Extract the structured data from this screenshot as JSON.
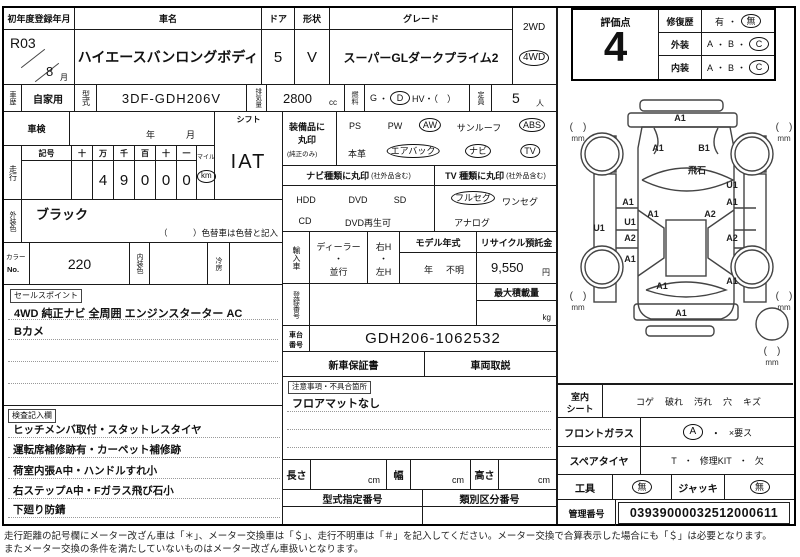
{
  "title_row": {
    "first_reg_label": "初年度登録年月",
    "first_reg_era": "R03",
    "first_reg_month": "8",
    "month_unit": "月",
    "car_name_label": "車名",
    "car_name": "ハイエースバンロングボディ",
    "door_label": "ドア",
    "door_count": "5",
    "shape_label": "形状",
    "shape": "V",
    "grade_label": "グレード",
    "grade": "スーパーGLダークプライム2",
    "drive_2wd": "2WD",
    "drive_4wd": "4WD",
    "drive_selected": "4WD"
  },
  "spec_row": {
    "history_label": "車歴",
    "history": "自家用",
    "model_label": "型式",
    "model_code": "3DF-GDH206V",
    "disp_label": "排気量",
    "displacement": "2800",
    "disp_unit": "cc",
    "fuel_label": "燃料",
    "fuel_gas": "G",
    "fuel_dot": "・",
    "fuel_diesel": "D",
    "fuel_hv": "HV・（　）",
    "fuel_selected": "D",
    "capacity_label": "定員",
    "capacity": "5",
    "capacity_unit": "人"
  },
  "shaken": {
    "label": "車検",
    "year_label": "年",
    "month_label": "月"
  },
  "shift": {
    "label": "シフト",
    "value": "IAT"
  },
  "odometer": {
    "label": "走行",
    "symbol_label": "記号",
    "digit_headers": [
      "十",
      "万",
      "千",
      "百",
      "十",
      "一"
    ],
    "digits": [
      "",
      "4",
      "9",
      "0",
      "0",
      "0"
    ],
    "mile_label": "マイル",
    "km_label": "km",
    "unit_selected": "km"
  },
  "equipment": {
    "label_line1": "装備品に",
    "label_line2": "丸印",
    "label_line3": "(純正のみ)",
    "row1": [
      {
        "label": "PS",
        "circled": false
      },
      {
        "label": "PW",
        "circled": false
      },
      {
        "label": "AW",
        "circled": true
      },
      {
        "label": "サンルーフ",
        "circled": false
      },
      {
        "label": "ABS",
        "circled": true
      }
    ],
    "row2": [
      {
        "label": "本革",
        "circled": false
      },
      {
        "label": "エアバック",
        "circled": true
      },
      {
        "label": "ナビ",
        "circled": true
      },
      {
        "label": "TV",
        "circled": true
      }
    ]
  },
  "nav_type": {
    "header": "ナビ種類に丸印",
    "header_note": "(社外品含む)",
    "row1": [
      "HDD",
      "DVD",
      "SD"
    ],
    "row2": [
      "CD",
      "DVD再生可"
    ]
  },
  "tv_type": {
    "header": "TV 種類に丸印",
    "header_note": "(社外品含む)",
    "row1": [
      {
        "label": "フルセグ",
        "circled": true
      },
      {
        "label": "ワンセグ",
        "circled": false
      }
    ],
    "row2": [
      "アナログ"
    ]
  },
  "exterior_color": {
    "label": "外装色",
    "value": "ブラック",
    "note": "（　　　）色替車は色替と記入"
  },
  "color_row": {
    "color_no_label1": "カラー",
    "color_no_label2": "No.",
    "color_no": "220",
    "interior_color_label": "内装色",
    "interior_color": "",
    "ac_label": "冷房",
    "ac": ""
  },
  "import_row": {
    "label": "輸入車",
    "dealer": "ディーラー",
    "dot": "・",
    "parallel": "並行",
    "rh": "右H",
    "lh": "左H",
    "model_year_label": "モデル年式",
    "model_year_unit": "年",
    "model_year_value": "不明",
    "recycle_label": "リサイクル預託金",
    "recycle_value": "9,550",
    "recycle_unit": "円"
  },
  "registration": {
    "label": "登録番号",
    "max_load_label": "最大積載量",
    "max_load_unit": "kg"
  },
  "chassis": {
    "label1": "車台",
    "label2": "番号",
    "value": "GDH206-1062532"
  },
  "docs": {
    "warranty": "新車保証書",
    "manual": "車両取説"
  },
  "sales_points": {
    "label": "セールスポイント",
    "line1": "4WD 純正ナビ 全周囲 エンジンスターター AC",
    "line2": "Bカメ"
  },
  "notes_section": {
    "label": "注意事項・不具合箇所",
    "line1": "フロアマットなし"
  },
  "inspection_notes": {
    "label": "検査記入欄",
    "lines": [
      "ヒッチメンバ取付・スタットレスタイヤ",
      "運転席補修跡有・カーペット補修跡",
      "荷室内張A中・ハンドルすれ小",
      "右ステップA中・Fガラス飛び石小",
      "下廻り防錆"
    ]
  },
  "dimensions": {
    "length_label": "長さ",
    "width_label": "幅",
    "height_label": "高さ",
    "unit": "cm"
  },
  "type_numbers": {
    "type_designation_label": "型式指定番号",
    "classification_label": "類別区分番号"
  },
  "rating": {
    "label": "評価点",
    "score": "4",
    "repair_label": "修復歴",
    "repair_yes": "有",
    "repair_no": "無",
    "repair_selected": "無",
    "exterior_label": "外装",
    "interior_label": "内装",
    "grade_a": "A",
    "grade_b": "B",
    "grade_c": "C",
    "dot": "・",
    "exterior_selected": "C",
    "interior_selected": "C"
  },
  "diagram": {
    "bracket": "(　)",
    "mm_label": "mm",
    "marks": [
      {
        "x": 122,
        "y": 30,
        "label": "A1"
      },
      {
        "x": 100,
        "y": 60,
        "label": "A1"
      },
      {
        "x": 146,
        "y": 60,
        "label": "B1"
      },
      {
        "x": 139,
        "y": 82,
        "label": "飛石"
      },
      {
        "x": 174,
        "y": 97,
        "label": "U1"
      },
      {
        "x": 70,
        "y": 114,
        "label": "A1"
      },
      {
        "x": 174,
        "y": 114,
        "label": "A1"
      },
      {
        "x": 95,
        "y": 126,
        "label": "A1"
      },
      {
        "x": 152,
        "y": 126,
        "label": "A2"
      },
      {
        "x": 72,
        "y": 134,
        "label": "U1"
      },
      {
        "x": 41,
        "y": 140,
        "label": "U1"
      },
      {
        "x": 72,
        "y": 150,
        "label": "A2"
      },
      {
        "x": 174,
        "y": 150,
        "label": "A2"
      },
      {
        "x": 72,
        "y": 171,
        "label": "A1"
      },
      {
        "x": 174,
        "y": 193,
        "label": "A1"
      },
      {
        "x": 104,
        "y": 198,
        "label": "A1"
      },
      {
        "x": 123,
        "y": 225,
        "label": "A1"
      }
    ],
    "mm_points": [
      {
        "x": 20,
        "y": 34
      },
      {
        "x": 226,
        "y": 34
      },
      {
        "x": 20,
        "y": 203
      },
      {
        "x": 226,
        "y": 203
      },
      {
        "x": 214,
        "y": 258
      }
    ]
  },
  "seat_row": {
    "label1": "室内",
    "label2": "シート",
    "items": [
      "コゲ",
      "破れ",
      "汚れ",
      "穴",
      "キズ"
    ]
  },
  "front_glass": {
    "label": "フロントガラス",
    "selected": "A",
    "dot": "・",
    "rest": "×要ス"
  },
  "spare_tire": {
    "label": "スペアタイヤ",
    "t": "T",
    "dot1": "・",
    "kit": "修理KIT",
    "dot2": "・",
    "missing": "欠"
  },
  "tools_row": {
    "tool_label": "工具",
    "tool_value": "無",
    "jack_label": "ジャッキ",
    "jack_value": "無"
  },
  "control": {
    "label": "管理番号",
    "value": "03939000032512000611"
  },
  "footer": {
    "line1": "走行距離の記号欄にメーター改ざん車は「＊」、メーター交換車は「＄」、走行不明車は「＃」を記入してください。メーター交換で合算表示した場合にも「＄」は必要となります。",
    "line2": "またメーター交換の条件を満たしていないものはメーター改ざん車扱いとなります。"
  }
}
